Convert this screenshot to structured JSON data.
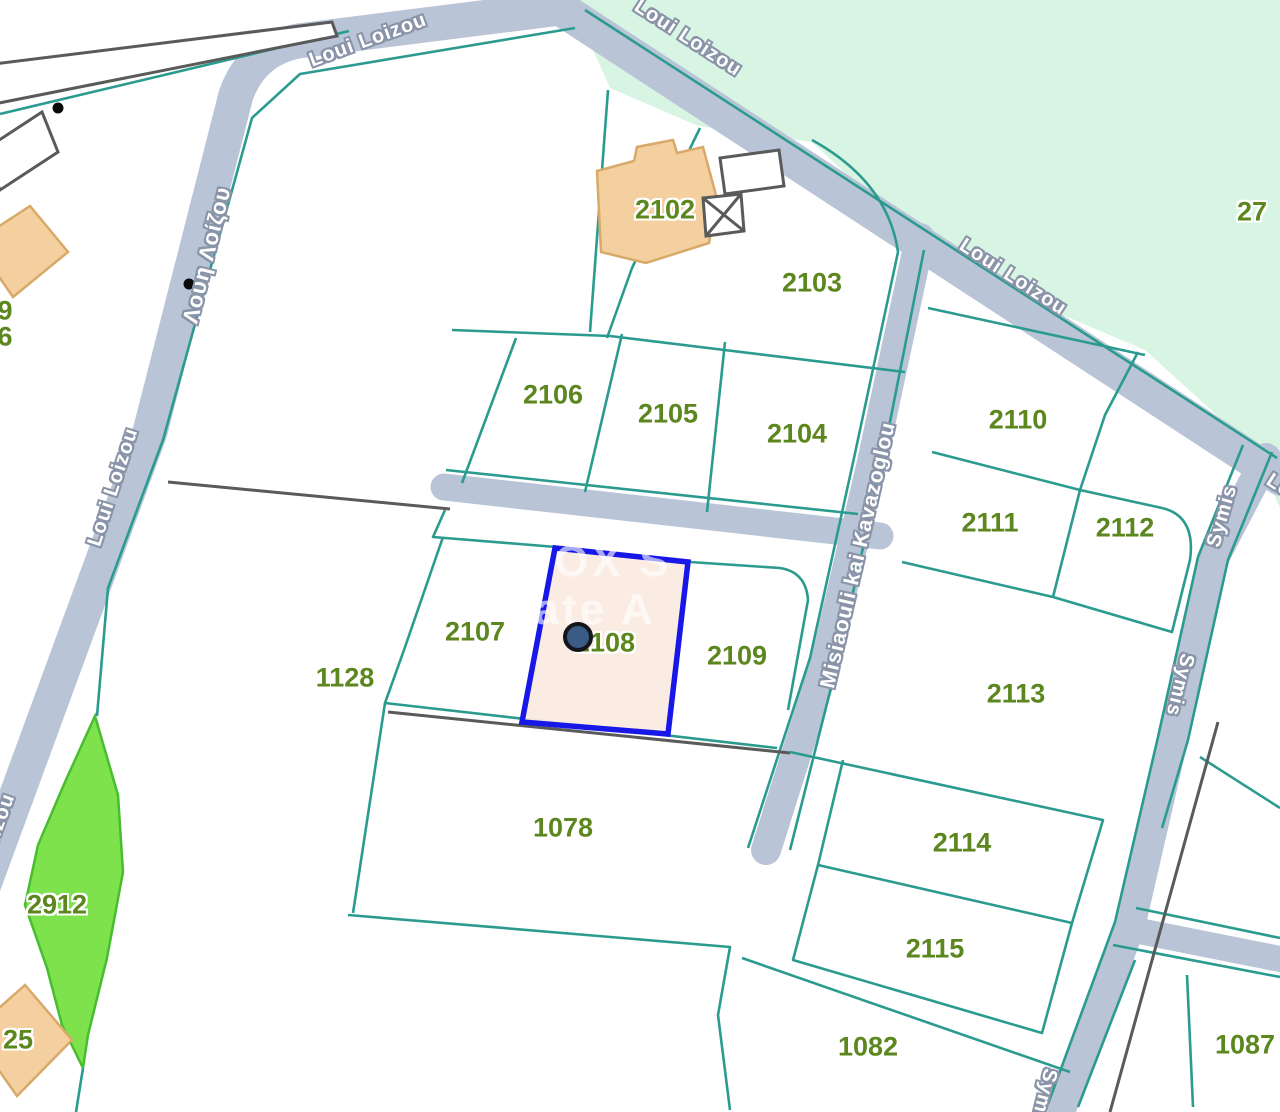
{
  "map": {
    "selected_parcel": {
      "id": "2108",
      "fill": "#FBEAE1",
      "border": "#1717E8"
    },
    "marker": {
      "x": 578,
      "y": 637
    },
    "colors": {
      "boundary": "#2B9B90",
      "road": "#B9C5D7",
      "mint": "#D8F5E4",
      "stripFill": "#7EE24D",
      "stripEdge": "#47BE2F",
      "building": "#F4D0A0",
      "buildingEdge": "#D8A968",
      "parcelLabel": "#5C861E",
      "selectedFill": "#FBEAE1",
      "selectedBorder": "#1717E8",
      "marker": "#3A5B86",
      "darkLine": "#5A5A5A",
      "streetText": "#FFFFFF",
      "streetHalo": "#8A94A8"
    },
    "labels": [
      {
        "name": "parcel-label-2102",
        "cls": "parcel",
        "text": "2102",
        "x": 665,
        "y": 210
      },
      {
        "name": "parcel-label-2103",
        "cls": "parcel",
        "text": "2103",
        "x": 812,
        "y": 283
      },
      {
        "name": "parcel-label-2106",
        "cls": "parcel",
        "text": "2106",
        "x": 553,
        "y": 395
      },
      {
        "name": "parcel-label-2105",
        "cls": "parcel",
        "text": "2105",
        "x": 668,
        "y": 414
      },
      {
        "name": "parcel-label-2104",
        "cls": "parcel",
        "text": "2104",
        "x": 797,
        "y": 434
      },
      {
        "name": "parcel-label-2110",
        "cls": "parcel",
        "text": "2110",
        "x": 1018,
        "y": 420
      },
      {
        "name": "parcel-label-2111",
        "cls": "parcel",
        "text": "2111",
        "x": 990,
        "y": 523
      },
      {
        "name": "parcel-label-2112",
        "cls": "parcel",
        "text": "2112",
        "x": 1125,
        "y": 528
      },
      {
        "name": "parcel-label-2107",
        "cls": "parcel",
        "text": "2107",
        "x": 475,
        "y": 632
      },
      {
        "name": "parcel-label-2108",
        "cls": "parcel",
        "text": "2108",
        "x": 605,
        "y": 643
      },
      {
        "name": "parcel-label-2109",
        "cls": "parcel",
        "text": "2109",
        "x": 737,
        "y": 656
      },
      {
        "name": "parcel-label-1128",
        "cls": "parcel",
        "text": "1128",
        "x": 345,
        "y": 678
      },
      {
        "name": "parcel-label-2113",
        "cls": "parcel",
        "text": "2113",
        "x": 1016,
        "y": 694
      },
      {
        "name": "parcel-label-1078",
        "cls": "parcel",
        "text": "1078",
        "x": 563,
        "y": 828
      },
      {
        "name": "parcel-label-2114",
        "cls": "parcel",
        "text": "2114",
        "x": 962,
        "y": 843
      },
      {
        "name": "parcel-label-2115",
        "cls": "parcel",
        "text": "2115",
        "x": 935,
        "y": 949
      },
      {
        "name": "parcel-label-1082",
        "cls": "parcel",
        "text": "1082",
        "x": 868,
        "y": 1047
      },
      {
        "name": "parcel-label-1087",
        "cls": "parcel",
        "text": "1087",
        "x": 1245,
        "y": 1045
      },
      {
        "name": "parcel-label-2912",
        "cls": "parcel",
        "text": "2912",
        "x": 57,
        "y": 905
      },
      {
        "name": "parcel-label-27",
        "cls": "parcel",
        "text": "27",
        "x": 1252,
        "y": 212
      },
      {
        "name": "parcel-label-25",
        "cls": "parcel",
        "text": "25",
        "x": 18,
        "y": 1040
      },
      {
        "name": "parcel-label-9",
        "cls": "parcel",
        "text": "9",
        "x": 5,
        "y": 311
      },
      {
        "name": "parcel-label-6",
        "cls": "parcel",
        "text": "6",
        "x": 5,
        "y": 337
      },
      {
        "name": "street-label-loui-loizou-1",
        "cls": "street",
        "text": "Loui Loizou",
        "x": 368,
        "y": 40,
        "rot": -20
      },
      {
        "name": "street-label-loui-loizou-2",
        "cls": "street",
        "text": "Loui Loizou",
        "x": 688,
        "y": 38,
        "rot": 33
      },
      {
        "name": "street-label-loui-loizou-3",
        "cls": "street",
        "text": "Loui Loizou",
        "x": 1013,
        "y": 277,
        "rot": 33
      },
      {
        "name": "street-label-loui-loizou-greek",
        "cls": "greek",
        "text": "Λουη Λοίζου",
        "x": 207,
        "y": 255,
        "rot": -76
      },
      {
        "name": "street-label-loui-loizou-4",
        "cls": "street",
        "text": "Loui Loizou",
        "x": 113,
        "y": 487,
        "rot": -72
      },
      {
        "name": "street-label-loui-loizou-5",
        "cls": "street",
        "text": "Loui Loizou",
        "x": -12,
        "y": 852,
        "rot": -70
      },
      {
        "name": "street-label-misiaouli-kai-kavazoglou",
        "cls": "street street-lg",
        "text": "Misiaouli kai Kavazoglou",
        "x": 858,
        "y": 555,
        "rot": -77
      },
      {
        "name": "street-label-symis-1",
        "cls": "street",
        "text": "Symis",
        "x": 1222,
        "y": 516,
        "rot": -74
      },
      {
        "name": "street-label-symis-2",
        "cls": "street",
        "text": "Symis",
        "x": 1180,
        "y": 685,
        "rot": 104
      },
      {
        "name": "street-label-symis-3",
        "cls": "street",
        "text": "Symis",
        "x": 1043,
        "y": 1100,
        "rot": 104
      },
      {
        "name": "street-label-loui-loizou-6",
        "cls": "street",
        "text": "Loui Loizou",
        "x": 1320,
        "y": 512,
        "rot": 33
      },
      {
        "name": "watermark-fragment-1",
        "cls": "watermark",
        "text": "OX S",
        "x": 613,
        "y": 562,
        "rot": 0
      },
      {
        "name": "watermark-fragment-2",
        "cls": "watermark",
        "text": "ate A",
        "x": 595,
        "y": 610,
        "rot": 0
      }
    ]
  }
}
